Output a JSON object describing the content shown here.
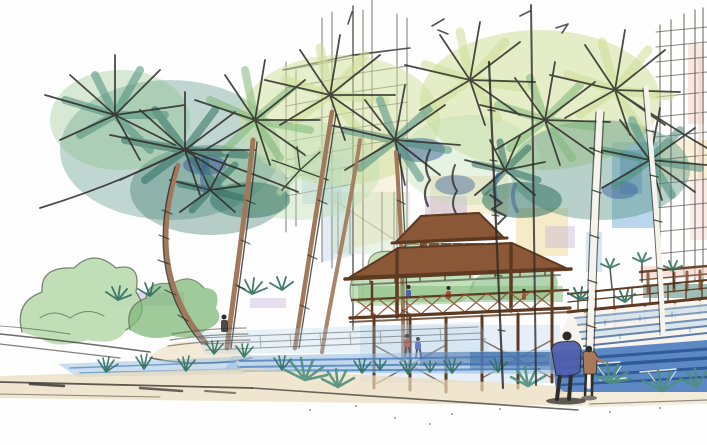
{
  "meta": {
    "kind": "hand-drawn watercolor / marker architectural concept sketch",
    "width_px": 707,
    "height_px": 445
  },
  "scene": {
    "description": "Watercolor concept sketch of a tropical resort plaza: tall sketched high-rise towers in the background, clusters of palm trees, a two-tier timber pavilion raised on posts, an elevated boardwalk, a stepped water cascade flowing into a blue reflecting pool, paved terraces, shrubs and agave plants, and two figures (an adult and a child) watching the water at the pool edge.",
    "elements": [
      "background-towers",
      "sky-patches",
      "palm-canopies",
      "palm-trunks",
      "shrubs",
      "timber-pavilion",
      "elevated-boardwalk",
      "cascade-steps",
      "reflecting-pools",
      "terrace-paving",
      "ground-walkway",
      "grass-and-agaves",
      "figures"
    ]
  },
  "colors": {
    "paper": "#fefefe",
    "ink": "#2e2b28",
    "ink_soft": "#5a544d",
    "foliage_teal": "#4e8f7d",
    "foliage_teal_deep": "#2f6f60",
    "foliage_green": "#7fb878",
    "foliage_yellow": "#cede97",
    "foliage_pale": "#b9dcae",
    "foliage_blue": "#3c5e9e",
    "trunk": "#a1785a",
    "trunk_dark": "#6f4a30",
    "trunk_white": "#f6f3ec",
    "wood": "#8a5737",
    "wood_dark": "#5e3a20",
    "water": "#3f74b8",
    "water_deep": "#27508f",
    "water_pale": "#9fc2e2",
    "wash_blue": "#aecfe9",
    "wash_yellow": "#f2e2b0",
    "wash_pink": "#f3cfc4",
    "wash_purple": "#b9a6d6",
    "ground": "#e9dcba",
    "figure_blue": "#4f5fae",
    "figure_red": "#b04f3c",
    "figure_tan": "#a9795a"
  }
}
